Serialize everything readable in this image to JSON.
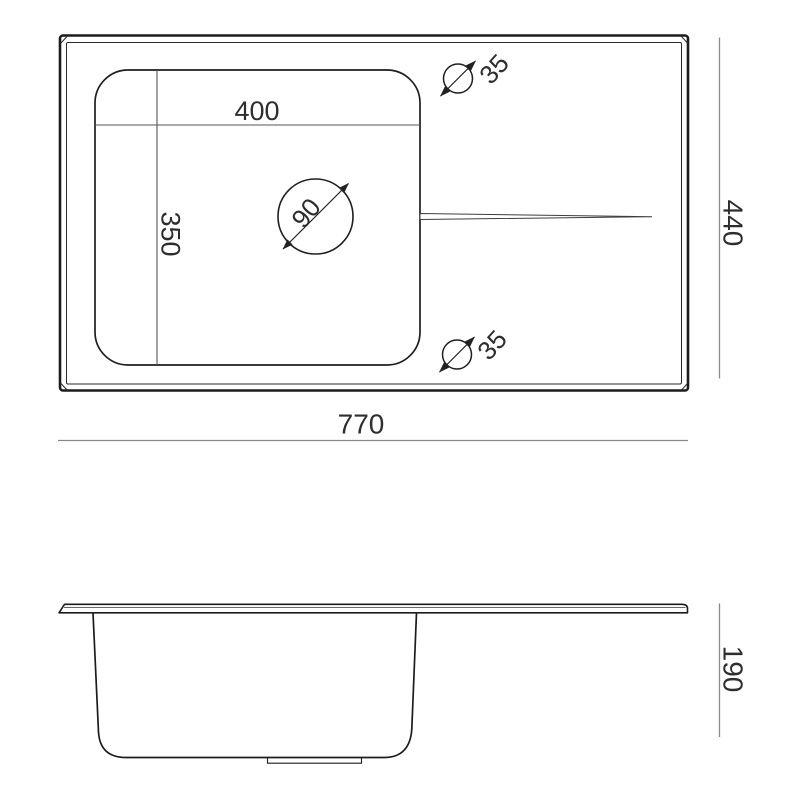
{
  "labels": {
    "bowl_width": "400",
    "bowl_length": "350",
    "drain_diameter": "90",
    "faucet_hole_top": "35",
    "faucet_hole_bottom": "35",
    "overall_width": "770",
    "overall_depth": "440",
    "bowl_height": "190"
  },
  "dimensions_mm": {
    "overall_width": 770,
    "overall_depth": 440,
    "bowl_width": 400,
    "bowl_length": 350,
    "bowl_depth": 190,
    "drain_hole_diameter": 90,
    "faucet_hole_diameter": 35
  },
  "colors": {
    "outline": "#1c1c1c",
    "inner_dimension_line": "#555555",
    "outer_dimension_line": "#8a8a8a",
    "label_text": "#2e2e2e",
    "background": "#ffffff"
  }
}
